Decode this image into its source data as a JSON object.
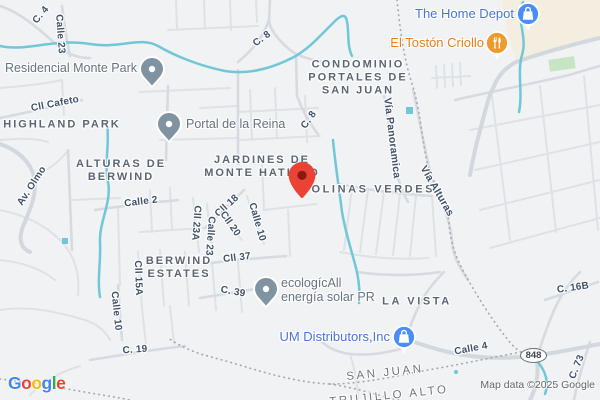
{
  "attribution": "Map data ©2025 Google",
  "logo": {
    "letters": [
      {
        "ch": "G",
        "color": "#4285F4"
      },
      {
        "ch": "o",
        "color": "#EA4335"
      },
      {
        "ch": "o",
        "color": "#FBBC05"
      },
      {
        "ch": "g",
        "color": "#4285F4"
      },
      {
        "ch": "l",
        "color": "#34A853"
      },
      {
        "ch": "e",
        "color": "#EA4335"
      }
    ]
  },
  "shield": {
    "route": "848"
  },
  "areas": [
    {
      "label": "HIGHLAND PARK"
    },
    {
      "label": "ALTURAS DE\nBERWIND"
    },
    {
      "label": "JARDINES DE\nMONTE HATILLO"
    },
    {
      "label": "COLINAS VERDES"
    },
    {
      "label": "CONDOMINIO\nPORTALES DE\nSAN JUAN"
    },
    {
      "label": "BERWIND\nESTATES"
    },
    {
      "label": "LA VISTA"
    }
  ],
  "municipalities": [
    {
      "label": "SAN JUAN"
    },
    {
      "label": "TRUJILLO ALTO"
    }
  ],
  "streets": [
    {
      "label": "C. 4"
    },
    {
      "label": "Calle 23"
    },
    {
      "label": "Cll Cafeto"
    },
    {
      "label": "Av. Olmo"
    },
    {
      "label": "Calle 2"
    },
    {
      "label": "Cll 18"
    },
    {
      "label": "Cll 23A"
    },
    {
      "label": "Calle 23"
    },
    {
      "label": "Cll 20"
    },
    {
      "label": "Calle 10"
    },
    {
      "label": "Cll 37"
    },
    {
      "label": "Cll 15A"
    },
    {
      "label": "Calle 10"
    },
    {
      "label": "C. 39"
    },
    {
      "label": "C. 19"
    },
    {
      "label": "C. 8"
    },
    {
      "label": "C. 8"
    },
    {
      "label": "Vía Panoramica"
    },
    {
      "label": "Vía Alturas"
    },
    {
      "label": "Calle 4"
    },
    {
      "label": "C. 16B"
    },
    {
      "label": "C. 73"
    }
  ],
  "pois": [
    {
      "name": "Residencial Monte Park",
      "type": "place"
    },
    {
      "name": "Portal de la Reina",
      "type": "place"
    },
    {
      "name": "ecologícAll\nenergía solar PR",
      "type": "place"
    },
    {
      "name": "The Home Depot",
      "type": "shopping"
    },
    {
      "name": "El Tostón Criollo",
      "type": "restaurant"
    },
    {
      "name": "UM Distributors,Inc",
      "type": "shopping"
    }
  ],
  "colors": {
    "water": "#71c7d7",
    "road": "#d8dde3",
    "poi_blue_text": "#4a72d9",
    "poi_orange_text": "#e97e17",
    "icon_blue": "#4b8df8",
    "icon_orange": "#f09a2d",
    "pin_red": "#EA4335",
    "pin_gray": "#8093a0",
    "commercial_area": "#f3eedf",
    "park_green": "#c7e5c2"
  }
}
